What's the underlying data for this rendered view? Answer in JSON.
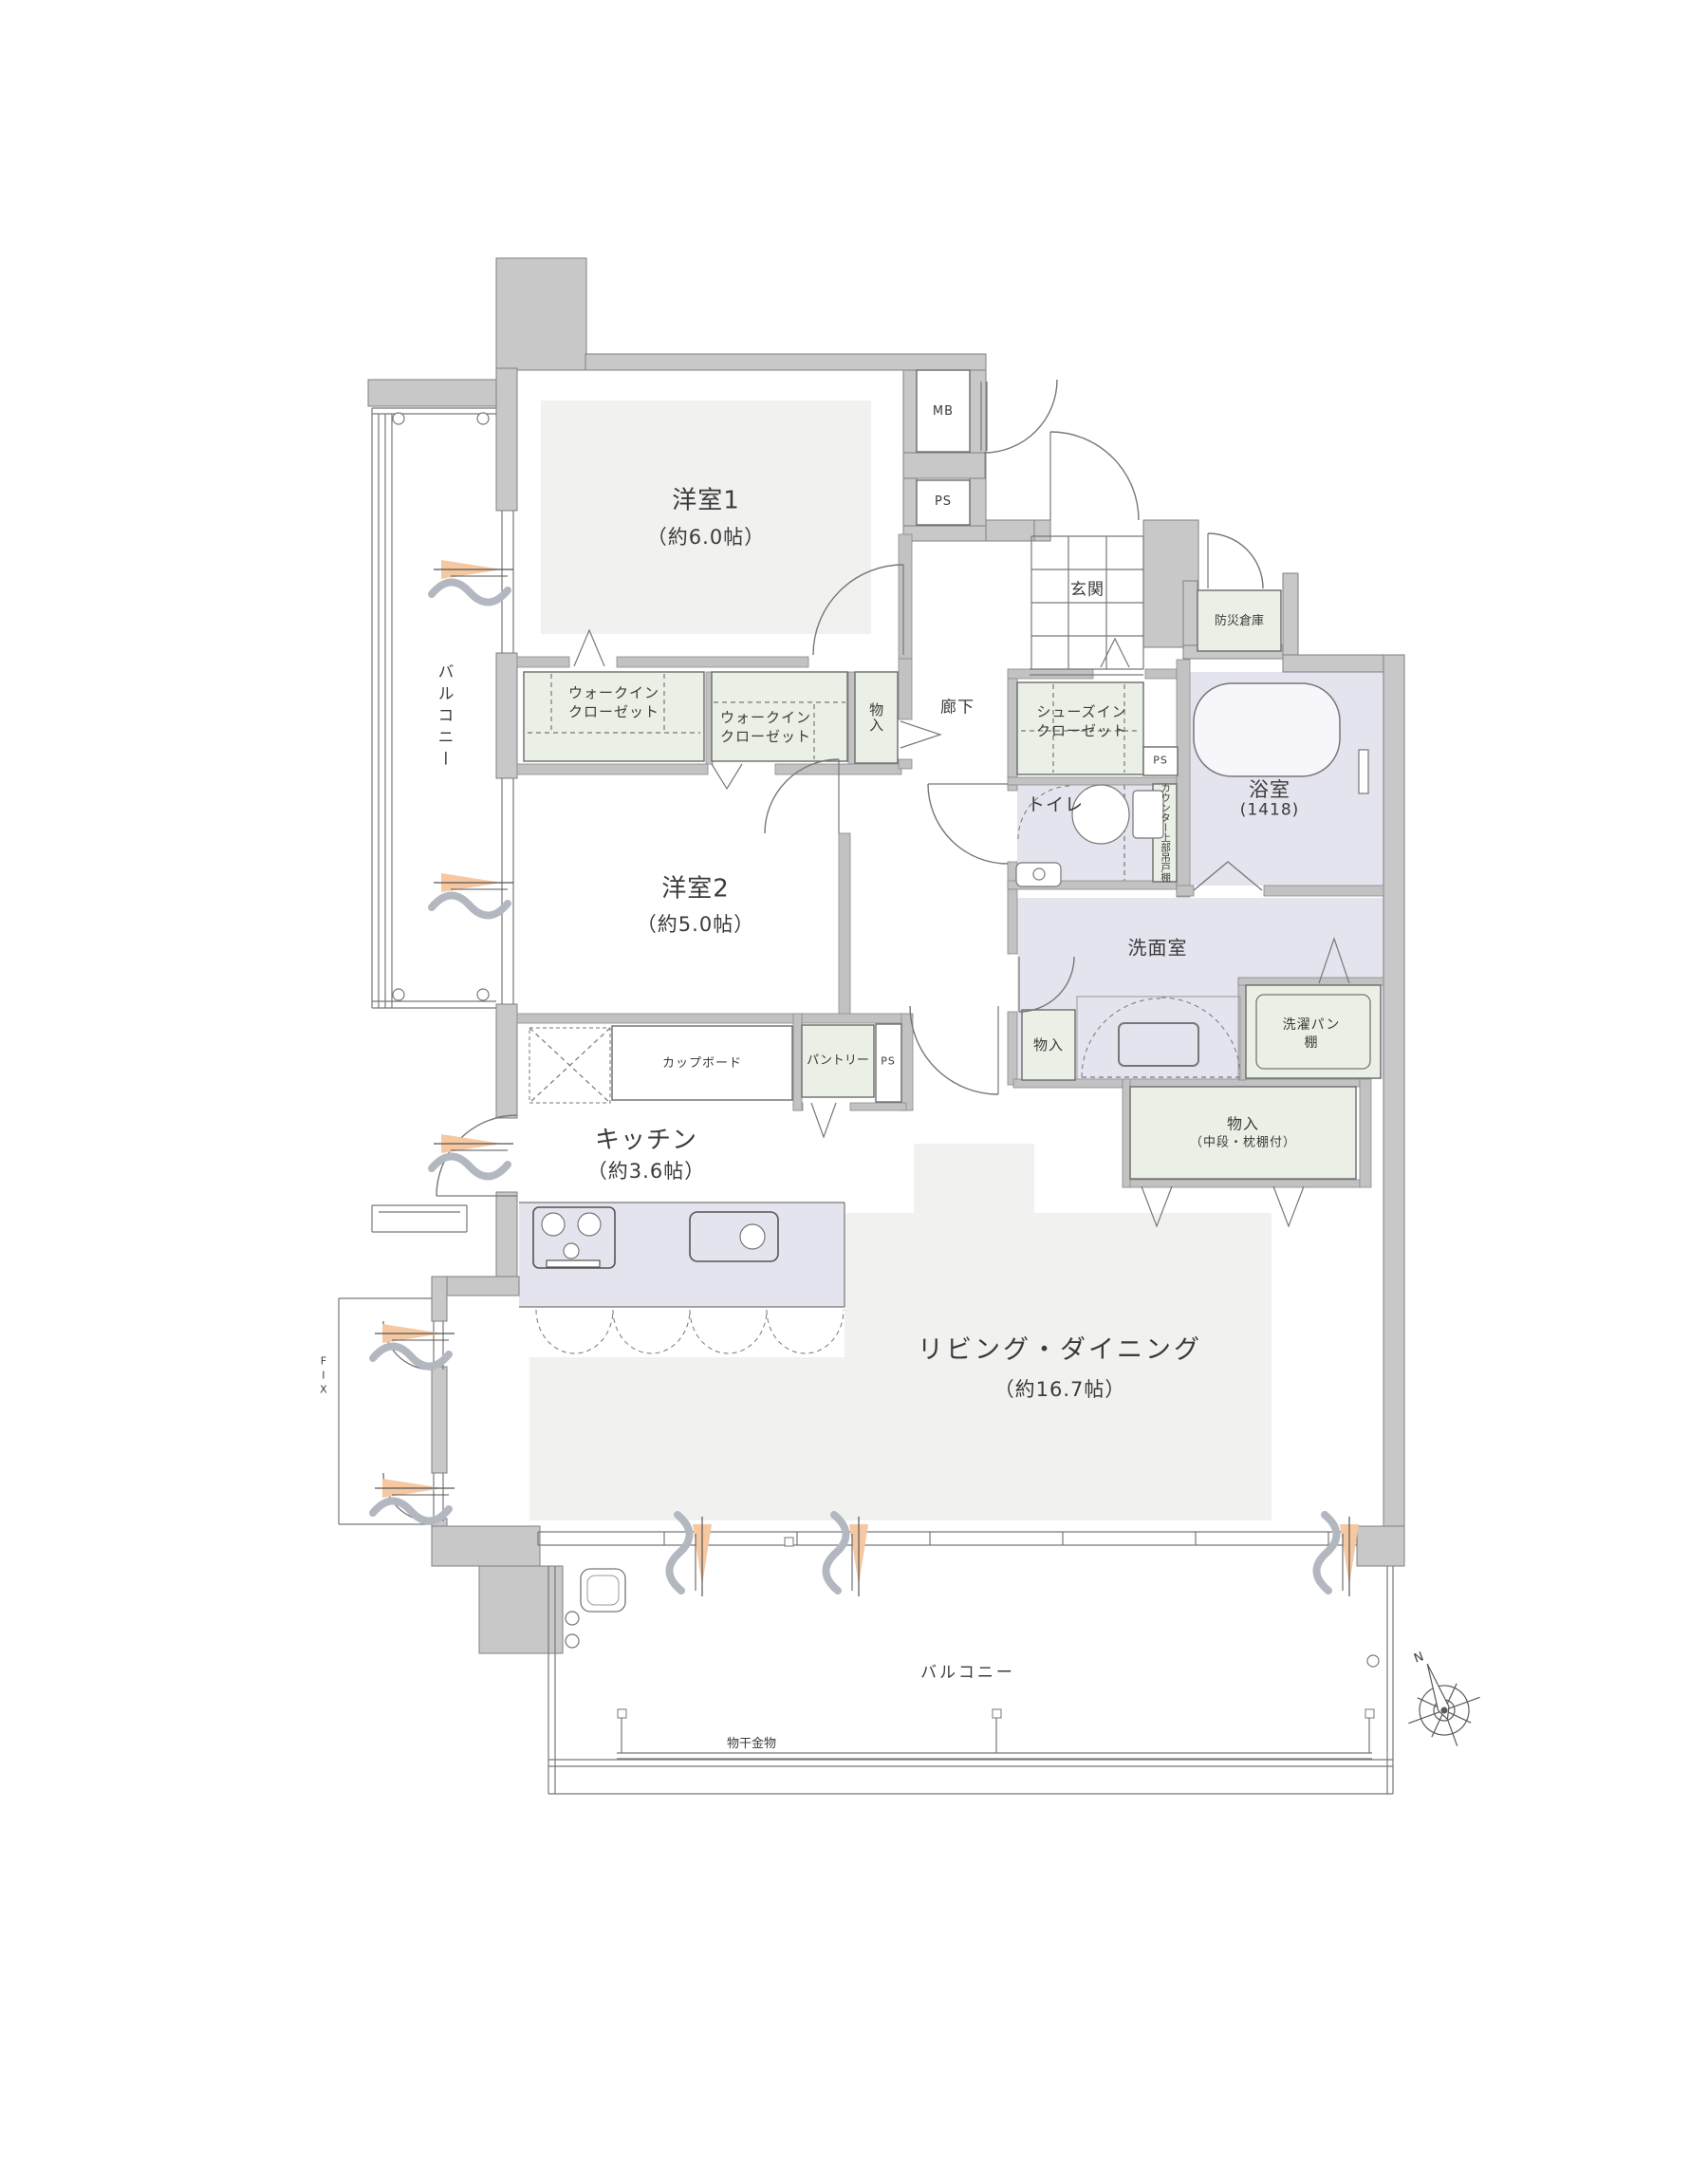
{
  "rooms": {
    "yoshitsu1": {
      "name": "洋室1",
      "size": "（約6.0帖）"
    },
    "yoshitsu2": {
      "name": "洋室2",
      "size": "（約5.0帖）"
    },
    "kitchen": {
      "name": "キッチン",
      "size": "（約3.6帖）"
    },
    "living": {
      "name": "リビング・ダイニング",
      "size": "（約16.7帖）"
    },
    "bath": {
      "name": "浴室",
      "size": "(1418)"
    },
    "washroom": {
      "name": "洗面室"
    },
    "toilet": {
      "name": "トイレ"
    },
    "genkan": {
      "name": "玄関"
    },
    "hallway": {
      "name": "廊下"
    },
    "balcony_left": {
      "name": "バルコニー"
    },
    "balcony_bottom": {
      "name": "バルコニー"
    }
  },
  "storage": {
    "wic1": {
      "line1": "ウォークイン",
      "line2": "クローゼット"
    },
    "wic2": {
      "line1": "ウォークイン",
      "line2": "クローゼット"
    },
    "shoes": {
      "line1": "シューズイン",
      "line2": "クローゼット"
    },
    "monoire_hall": "物入",
    "monoire_wash": "物入",
    "monoire_ld": {
      "line1": "物入",
      "line2": "（中段・枕棚付）"
    },
    "laundry_shelf": {
      "line1": "洗濯パン",
      "line2": "棚"
    },
    "pantry": "パントリー",
    "cupboard": "カップボード",
    "counter_shelf": "カウンター上部吊戸棚",
    "bosai": "防災倉庫"
  },
  "labels": {
    "mb": "MB",
    "ps": "PS",
    "fix": "FIX",
    "monohoshi": "物干金物",
    "north": "N"
  },
  "colors": {
    "wall_gray": "#c8c8c8",
    "room_gray": "#f1f1f0",
    "closet_green": "#eaf0e6",
    "wet_lavender": "#e4e4ee",
    "vent_orange": "#f5c8a1"
  }
}
